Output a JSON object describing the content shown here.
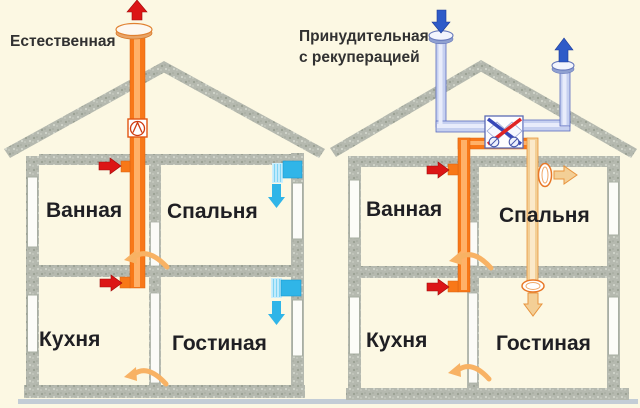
{
  "colors": {
    "background": "#fcf8e3",
    "orange_duct": "#f87818",
    "orange_duct_light": "#ffb168",
    "red_arrow": "#dc1616",
    "blue_arrow": "#2e5bc8",
    "pale_blue_duct": "#c6d0f0",
    "pale_blue_duct_stroke": "#5a6cc0",
    "cyan_vent": "#30b5e8",
    "cyan_vent_pale": "#cdeffc",
    "cream_supply": "#f3cf96",
    "cream_supply_stroke": "#e8943e",
    "transfer_arrow": "#f8b264",
    "label_text": "#1f1f23"
  },
  "icons": {
    "exhaust_out": "red-up-arrow-icon",
    "extract_grille": "red-right-arrow-icon",
    "fresh_intake": "blue-down-arrow-icon",
    "exhaust_stack": "blue-up-arrow-icon",
    "wall_vent": "cyan-vent-icon",
    "fan": "fan-icon",
    "recuperator": "heat-exchanger-icon",
    "transfer": "curved-transfer-arrow-icon"
  },
  "left_house": {
    "title": "Естественная",
    "rooms": {
      "bathroom": "Ванная",
      "bedroom": "Спальня",
      "kitchen": "Кухня",
      "living_room": "Гостиная"
    }
  },
  "right_house": {
    "title_line1": "Принудительная",
    "title_line2": "с рекуперацией",
    "rooms": {
      "bathroom": "Ванная",
      "bedroom": "Спальня",
      "kitchen": "Кухня",
      "living_room": "Гостиная"
    }
  }
}
